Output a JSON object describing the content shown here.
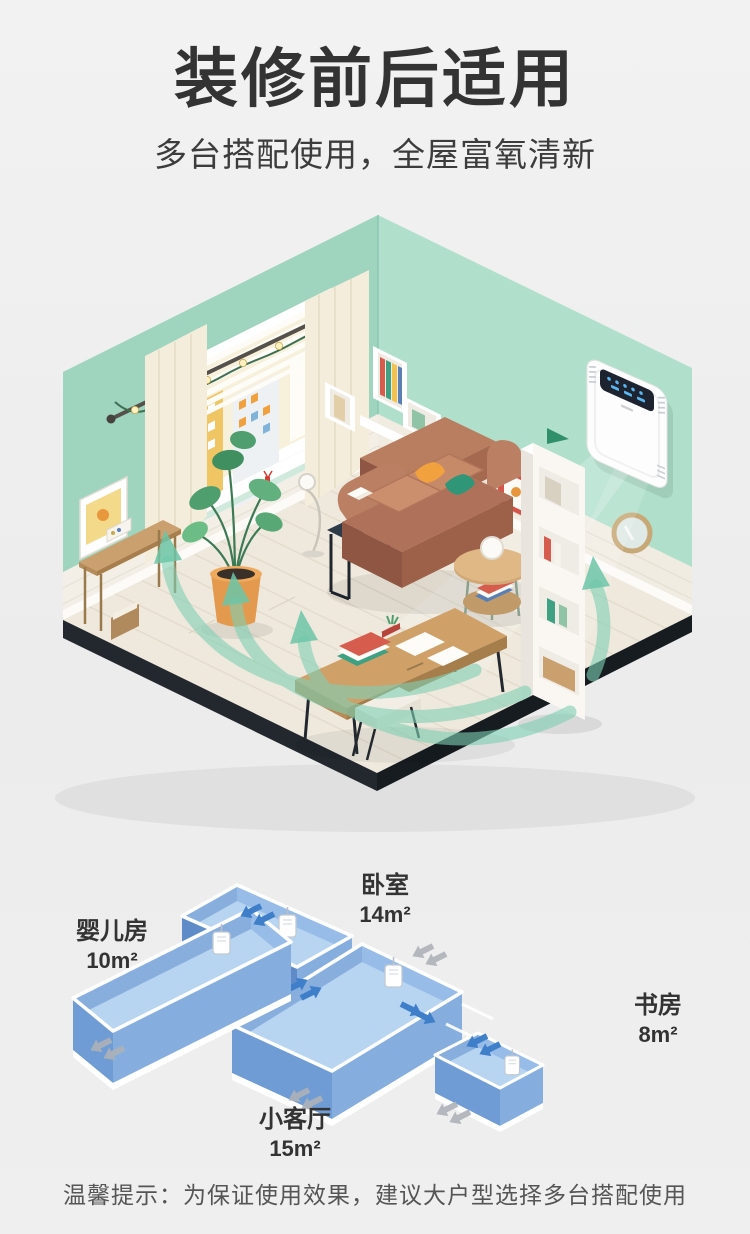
{
  "header": {
    "title": "装修前后适用",
    "subtitle": "多台搭配使用，全屋富氧清新"
  },
  "room_illustration": {
    "description": "isometric living room with wall-mounted fresh air purifier blowing fresh airflow",
    "wall_color": "#a6d8c3",
    "floor_color": "#efe9dd",
    "airflow_color": "#7ed0b4",
    "device": {
      "name": "fresh-air-unit",
      "body_color": "#fdfdfd",
      "screen_color": "#1d2430",
      "indicator_color": "#58b6f0"
    }
  },
  "floorplan": {
    "rooms": [
      {
        "id": "baby-room",
        "label": "婴儿房",
        "area": "10m²"
      },
      {
        "id": "bedroom",
        "label": "卧室",
        "area": "14m²"
      },
      {
        "id": "study",
        "label": "书房",
        "area": "8m²"
      },
      {
        "id": "living-room",
        "label": "小客厅",
        "area": "15m²"
      }
    ],
    "box_color": "#b7d4f1",
    "arrow_in_color": "#3f7fc9",
    "arrow_out_color": "#aeb2b8"
  },
  "footer": {
    "tip": "温馨提示：为保证使用效果，建议大户型选择多台搭配使用"
  }
}
